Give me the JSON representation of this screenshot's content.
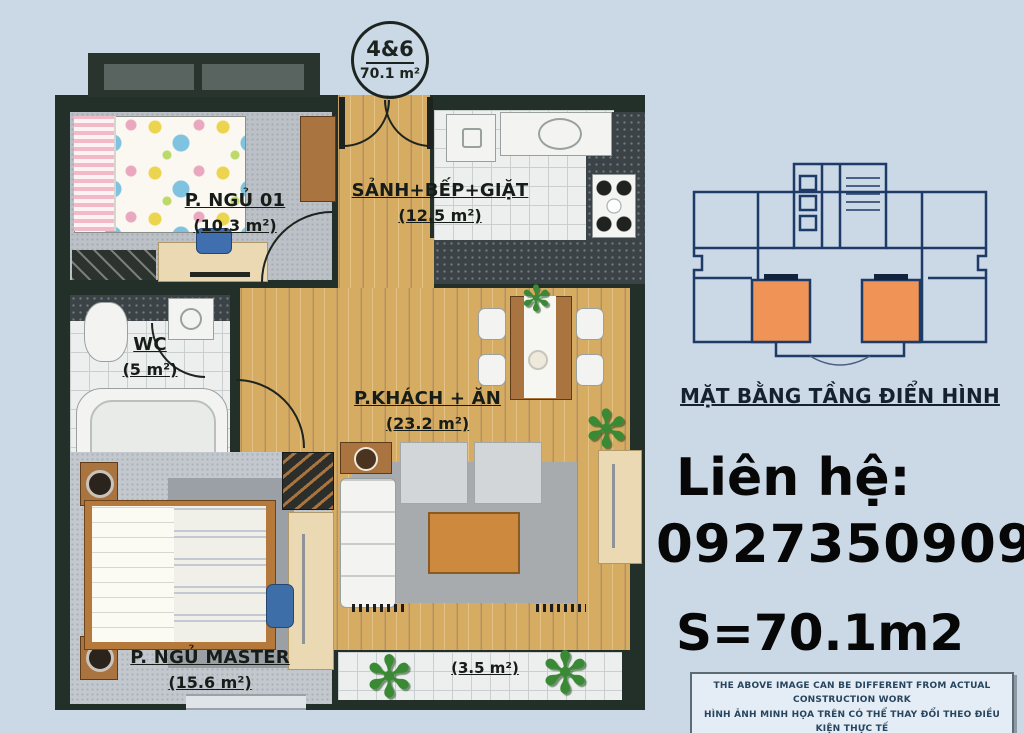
{
  "page": {
    "bg": "#cbd8e6"
  },
  "badge": {
    "unit": "4&6",
    "area": "70.1 m²"
  },
  "plan": {
    "rooms": [
      {
        "id": "bedroom-01",
        "label": "P. NGỦ 01",
        "area": "(10.3 m²)"
      },
      {
        "id": "hall-kitchen-laundry",
        "label": "SẢNH+BẾP+GIẶT",
        "area": "(12.5 m²)"
      },
      {
        "id": "wc",
        "label": "WC",
        "area": "(5 m²)"
      },
      {
        "id": "living-dining",
        "label": "P.KHÁCH + ĂN",
        "area": "(23.2 m²)"
      },
      {
        "id": "master-bedroom",
        "label": "P. NGỦ MASTER",
        "area": "(15.6 m²)"
      },
      {
        "id": "balcony",
        "label": "",
        "area": "(3.5 m²)"
      }
    ]
  },
  "keyplan": {
    "title": "MẶT BẰNG TẦNG ĐIỂN HÌNH",
    "highlight": "#ef9356",
    "line": "#1d3b66"
  },
  "contact": {
    "heading": "Liên hệ:",
    "phone": "0927350909",
    "size": "S=70.1m2"
  },
  "disclaimer": {
    "en": "THE ABOVE IMAGE CAN BE DIFFERENT FROM ACTUAL CONSTRUCTION WORK",
    "vi": "HÌNH ẢNH MINH HỌA TRÊN CÓ THỂ THAY ĐỔI THEO ĐIỀU KIỆN THỰC TẾ"
  },
  "icons": {
    "plant": "✻"
  },
  "colors": {
    "wall": "#233029",
    "wood": "#d6ab62",
    "orange": "#ef9356",
    "navy": "#1d3b66",
    "background": "#cbd8e6"
  }
}
